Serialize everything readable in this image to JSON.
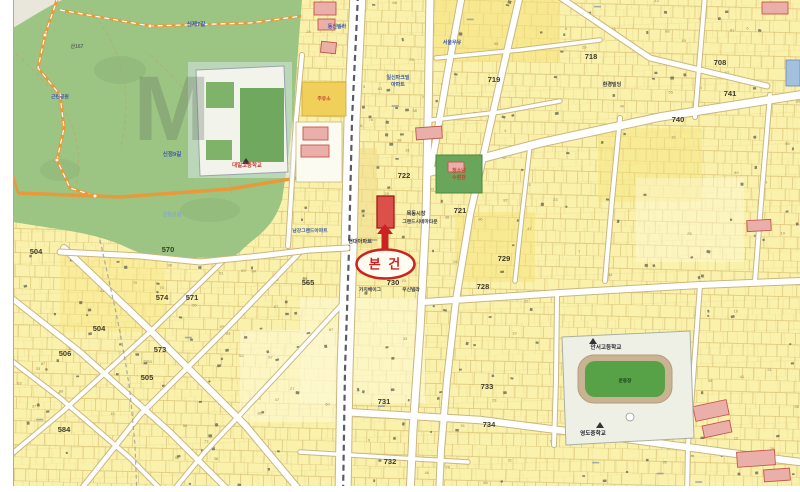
{
  "marker": {
    "label": "본 건"
  },
  "watermark": {
    "text": "M"
  },
  "block_numbers": [
    {
      "t": "504",
      "x": 36,
      "y": 254
    },
    {
      "t": "570",
      "x": 168,
      "y": 252
    },
    {
      "t": "574",
      "x": 162,
      "y": 300
    },
    {
      "t": "571",
      "x": 192,
      "y": 300
    },
    {
      "t": "573",
      "x": 160,
      "y": 352
    },
    {
      "t": "505",
      "x": 147,
      "y": 380
    },
    {
      "t": "504",
      "x": 99,
      "y": 331
    },
    {
      "t": "506",
      "x": 65,
      "y": 356
    },
    {
      "t": "584",
      "x": 64,
      "y": 432
    },
    {
      "t": "565",
      "x": 308,
      "y": 285
    },
    {
      "t": "722",
      "x": 404,
      "y": 178
    },
    {
      "t": "721",
      "x": 460,
      "y": 213
    },
    {
      "t": "729",
      "x": 504,
      "y": 261
    },
    {
      "t": "728",
      "x": 483,
      "y": 289
    },
    {
      "t": "730",
      "x": 393,
      "y": 285
    },
    {
      "t": "731",
      "x": 384,
      "y": 404
    },
    {
      "t": "733",
      "x": 487,
      "y": 389
    },
    {
      "t": "734",
      "x": 489,
      "y": 427
    },
    {
      "t": "732",
      "x": 390,
      "y": 464
    },
    {
      "t": "718",
      "x": 591,
      "y": 59
    },
    {
      "t": "719",
      "x": 494,
      "y": 82
    },
    {
      "t": "708",
      "x": 720,
      "y": 65
    },
    {
      "t": "740",
      "x": 678,
      "y": 122
    },
    {
      "t": "741",
      "x": 730,
      "y": 96
    }
  ],
  "labels": [
    {
      "t": "현대아파트",
      "x": 360,
      "y": 243,
      "c": "#3a3a46",
      "s": 5.2
    },
    {
      "t": "남강그랜드아파트",
      "x": 310,
      "y": 232,
      "c": "#3b57a8",
      "s": 4.8
    },
    {
      "t": "동신빌라",
      "x": 337,
      "y": 28,
      "c": "#3b57a8",
      "s": 5
    },
    {
      "t": "일신파크빌",
      "x": 398,
      "y": 79,
      "c": "#3b57a8",
      "s": 5
    },
    {
      "t": "아파트",
      "x": 398,
      "y": 86,
      "c": "#3b57a8",
      "s": 5
    },
    {
      "t": "서울우유",
      "x": 452,
      "y": 44,
      "c": "#3b57a8",
      "s": 5
    },
    {
      "t": "환경빌딩",
      "x": 612,
      "y": 86,
      "c": "#3a3a46",
      "s": 5
    },
    {
      "t": "목동시장",
      "x": 416,
      "y": 215,
      "c": "#3a3a46",
      "s": 5.2
    },
    {
      "t": "그랜드시네마타운",
      "x": 420,
      "y": 223,
      "c": "#3a3a46",
      "s": 4.8
    },
    {
      "t": "가치베이그",
      "x": 370,
      "y": 291,
      "c": "#3a3a46",
      "s": 4.8
    },
    {
      "t": "우신빌라",
      "x": 411,
      "y": 291,
      "c": "#3a3a46",
      "s": 4.8
    },
    {
      "t": "주유소",
      "x": 324,
      "y": 100,
      "c": "#c03a30",
      "s": 4.8
    },
    {
      "t": "청소년",
      "x": 459,
      "y": 172,
      "c": "#d03b2e",
      "s": 5
    },
    {
      "t": "수련관",
      "x": 459,
      "y": 179,
      "c": "#d03b2e",
      "s": 5
    },
    {
      "t": "대일고등학교",
      "x": 247,
      "y": 167,
      "c": "#c03a30",
      "s": 5.4
    },
    {
      "t": "안서고등학교",
      "x": 606,
      "y": 349,
      "c": "#2a2a33",
      "s": 5.6
    },
    {
      "t": "운동장",
      "x": 625,
      "y": 382,
      "c": "#173a17",
      "s": 4.6
    },
    {
      "t": "영도중학교",
      "x": 593,
      "y": 435,
      "c": "#2a2a33",
      "s": 5.6
    }
  ],
  "park_labels": [
    {
      "t": "신제7길",
      "x": 196,
      "y": 26,
      "c": "#3b57a8",
      "s": 5.6
    },
    {
      "t": "신정9길",
      "x": 172,
      "y": 156,
      "c": "#3b57a8",
      "s": 5.6
    },
    {
      "t": "산167",
      "x": 77,
      "y": 48,
      "c": "#5a6a58",
      "s": 5
    },
    {
      "t": "근린공원",
      "x": 60,
      "y": 98,
      "c": "#3b57a8",
      "s": 4.8
    },
    {
      "t": "신정산길",
      "x": 172,
      "y": 216,
      "c": "#86a8cc",
      "s": 5
    }
  ],
  "colors": {
    "parcel_yellow": "#FAF2AC",
    "park_green": "#9CC483",
    "road_white": "#FFFFFF",
    "road_casing": "#C9B77E",
    "marker_red": "#CC2320",
    "subject_red": "#DB5048",
    "field_green": "#57A247",
    "track_tan": "#C9B393",
    "building_pink": "#E9AFA8",
    "building_blue": "#A3C0DE",
    "facility_green": "#69A55B"
  }
}
